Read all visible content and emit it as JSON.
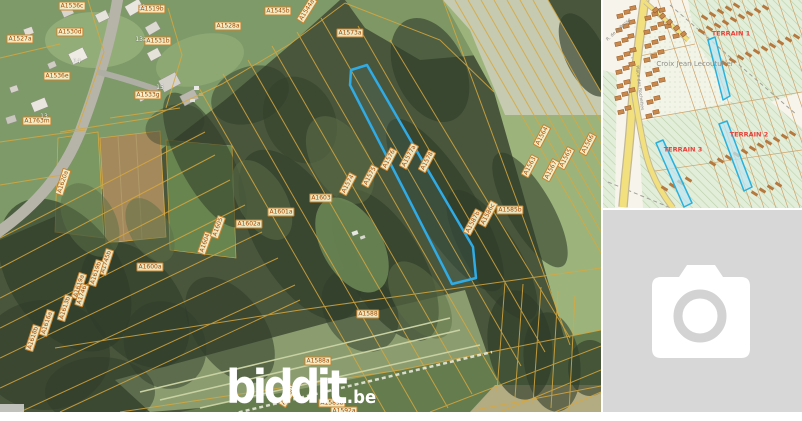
{
  "aerial": {
    "watermark": {
      "brand": "biddit",
      "tld": ".be"
    },
    "parcel_labels": [
      {
        "text": "A1536c",
        "x": 72,
        "y": 6,
        "r": 0
      },
      {
        "text": "A1519b",
        "x": 152,
        "y": 9,
        "r": 0
      },
      {
        "text": "A1545b",
        "x": 278,
        "y": 11,
        "r": 0
      },
      {
        "text": "A1544a",
        "x": 307,
        "y": 10,
        "r": -58
      },
      {
        "text": "A1527a",
        "x": 20,
        "y": 39,
        "r": 0
      },
      {
        "text": "A1530d",
        "x": 70,
        "y": 32,
        "r": 0
      },
      {
        "text": "A1531b",
        "x": 158,
        "y": 41,
        "r": 0
      },
      {
        "text": "A1528a",
        "x": 228,
        "y": 26,
        "r": 0
      },
      {
        "text": "A1573a",
        "x": 350,
        "y": 33,
        "r": 0
      },
      {
        "text": "A1536e",
        "x": 57,
        "y": 76,
        "r": 0
      },
      {
        "text": "A1533g",
        "x": 148,
        "y": 95,
        "r": 0
      },
      {
        "text": "A1763m",
        "x": 37,
        "y": 121,
        "r": 0
      },
      {
        "text": "A1620a",
        "x": 63,
        "y": 182,
        "r": -72
      },
      {
        "text": "A1574",
        "x": 348,
        "y": 184,
        "r": -62
      },
      {
        "text": "A1575",
        "x": 370,
        "y": 176,
        "r": -62
      },
      {
        "text": "A1576",
        "x": 389,
        "y": 159,
        "r": -62
      },
      {
        "text": "A1577a",
        "x": 409,
        "y": 156,
        "r": -62
      },
      {
        "text": "A1578",
        "x": 427,
        "y": 161,
        "r": -62
      },
      {
        "text": "A1563",
        "x": 530,
        "y": 166,
        "r": -62
      },
      {
        "text": "A1564",
        "x": 542,
        "y": 136,
        "r": -62
      },
      {
        "text": "A1565",
        "x": 566,
        "y": 158,
        "r": -62
      },
      {
        "text": "A1566",
        "x": 588,
        "y": 144,
        "r": -62
      },
      {
        "text": "A1567",
        "x": 551,
        "y": 170,
        "r": -62
      },
      {
        "text": "A1585b",
        "x": 510,
        "y": 210,
        "r": 0
      },
      {
        "text": "A1586c",
        "x": 488,
        "y": 214,
        "r": -62
      },
      {
        "text": "A1587b",
        "x": 473,
        "y": 222,
        "r": -62
      },
      {
        "text": "A1600a",
        "x": 150,
        "y": 267,
        "r": 0
      },
      {
        "text": "A1604",
        "x": 205,
        "y": 243,
        "r": -70
      },
      {
        "text": "A1605",
        "x": 218,
        "y": 227,
        "r": -70
      },
      {
        "text": "A1602a",
        "x": 249,
        "y": 224,
        "r": 0
      },
      {
        "text": "A1601a",
        "x": 281,
        "y": 212,
        "r": 0
      },
      {
        "text": "A1603",
        "x": 321,
        "y": 198,
        "r": 0
      },
      {
        "text": "A1745b",
        "x": 106,
        "y": 262,
        "r": -72
      },
      {
        "text": "A1619b",
        "x": 96,
        "y": 273,
        "r": -72
      },
      {
        "text": "A1619a",
        "x": 79,
        "y": 286,
        "r": -72
      },
      {
        "text": "A1746",
        "x": 82,
        "y": 295,
        "r": -72
      },
      {
        "text": "A1613b",
        "x": 65,
        "y": 308,
        "r": -72
      },
      {
        "text": "A1616a",
        "x": 47,
        "y": 323,
        "r": -72
      },
      {
        "text": "A1618b",
        "x": 33,
        "y": 338,
        "r": -72
      },
      {
        "text": "A1588",
        "x": 368,
        "y": 314,
        "r": 0
      },
      {
        "text": "A1588a",
        "x": 318,
        "y": 361,
        "r": 0
      },
      {
        "text": "A1590",
        "x": 288,
        "y": 396,
        "r": -58
      },
      {
        "text": "A1589b",
        "x": 332,
        "y": 403,
        "r": 0
      },
      {
        "text": "A1592a",
        "x": 344,
        "y": 411,
        "r": 0
      }
    ],
    "house_numbers": [
      {
        "text": "11",
        "x": 142,
        "y": 8,
        "r": 0
      },
      {
        "text": "14",
        "x": 77,
        "y": 62,
        "r": 0
      },
      {
        "text": "13a",
        "x": 141,
        "y": 40,
        "r": 0
      },
      {
        "text": "15",
        "x": 160,
        "y": 88,
        "r": 0
      },
      {
        "text": "13",
        "x": 44,
        "y": 117,
        "r": 0
      }
    ]
  },
  "map": {
    "terrain_labels": [
      {
        "text": "TERRAIN 1",
        "x": 128,
        "y": 34,
        "r": 0
      },
      {
        "text": "TERRAIN 2",
        "x": 146,
        "y": 135,
        "r": 0
      },
      {
        "text": "TERRAIN 3",
        "x": 80,
        "y": 150,
        "r": 0
      }
    ],
    "place_label": {
      "text": "Croix Jean Lecouturier",
      "x": 92,
      "y": 64,
      "r": 0
    },
    "street_labels": [
      {
        "text": "Place des Rochettes",
        "x": 36,
        "y": 88,
        "r": 83
      },
      {
        "text": "R. de la Basse",
        "x": 16,
        "y": 30,
        "r": -42
      }
    ]
  },
  "photo_placeholder": {
    "icon": "camera-icon"
  },
  "colors": {
    "parcel_boundary": "#d8a83e",
    "parcel_highlight": "#2fabe6",
    "map_highlight": "#29b1dd",
    "terrain_label_color": "#e8413a",
    "placeholder_bg": "#d7d7d7"
  }
}
